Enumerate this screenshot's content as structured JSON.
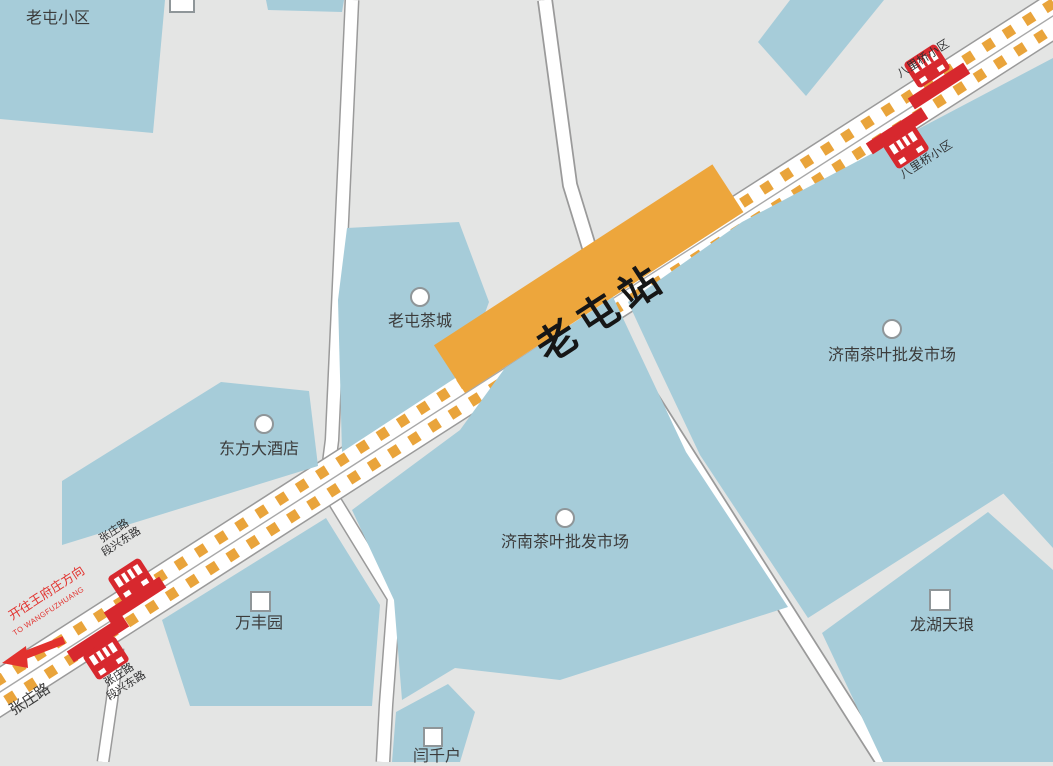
{
  "station": {
    "name": "老屯站"
  },
  "transit": {
    "direction_cn": "开往王府庄方向",
    "direction_en": "TO WANGFUZHUANG",
    "road_name": "张庄路"
  },
  "stops": {
    "baliqiao": {
      "name": "八里桥小区"
    },
    "zhangzhuang": {
      "line1": "张庄路",
      "line2": "段兴东路"
    }
  },
  "places": {
    "laotun_xiaoqu": {
      "name": "老屯小区",
      "marker": "square"
    },
    "laotun_teacity": {
      "name": "老屯茶城",
      "marker": "circle"
    },
    "dongfang_hotel": {
      "name": "东方大酒店",
      "marker": "circle"
    },
    "tea_market": {
      "name": "济南茶叶批发市场",
      "marker": "circle"
    },
    "wanfengyuan": {
      "name": "万丰园",
      "marker": "square"
    },
    "longhu": {
      "name": "龙湖天琅",
      "marker": "square"
    },
    "yanqianhu": {
      "name": "闫千户",
      "marker": "square"
    }
  },
  "colors": {
    "map_background": "#e4e5e4",
    "block_blue": "#a6ccd9",
    "route_orange": "#eda63c",
    "dash_orange": "#e9a43b",
    "bus_red": "#d7282e",
    "direction_red": "#e2322e"
  }
}
